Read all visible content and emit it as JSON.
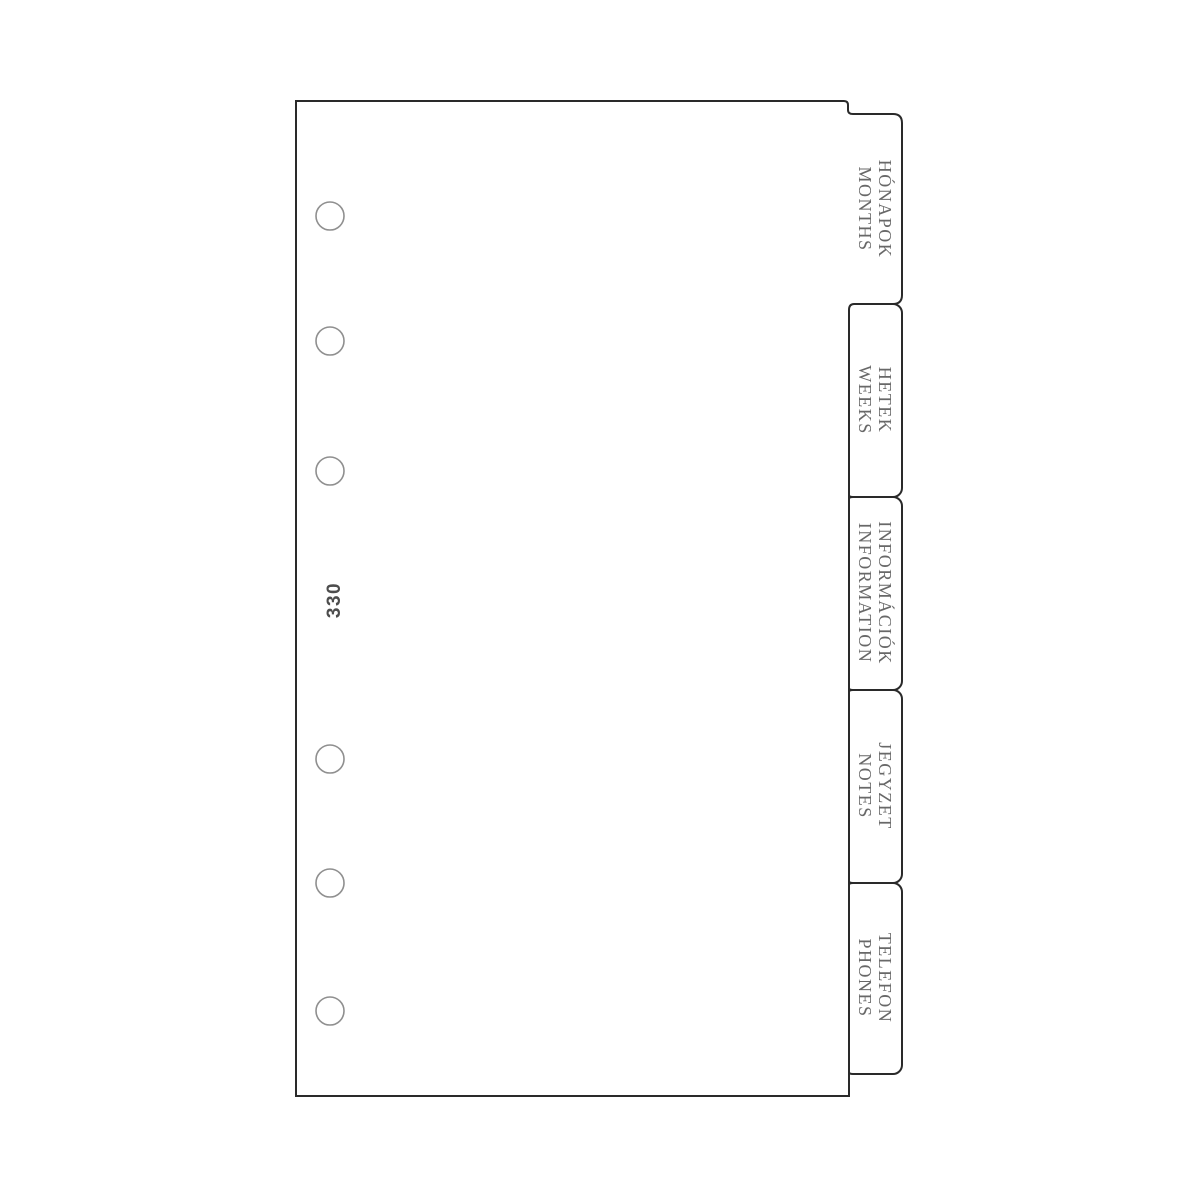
{
  "product": {
    "page_number": "330"
  },
  "divider": {
    "tabs": [
      {
        "line1": "HÓNAPOK",
        "line2": "MONTHS"
      },
      {
        "line1": "HETEK",
        "line2": "WEEKS"
      },
      {
        "line1": "INFORMÁCIÓK",
        "line2": "INFORMATION"
      },
      {
        "line1": "JEGYZET",
        "line2": "NOTES"
      },
      {
        "line1": "TELEFON",
        "line2": "PHONES"
      }
    ]
  },
  "colors": {
    "paper": "#ffffff",
    "outline": "#2a2a2a",
    "hole_stroke": "#8f8f8f",
    "label_text": "#686868",
    "number_text": "#4d4d4d"
  }
}
